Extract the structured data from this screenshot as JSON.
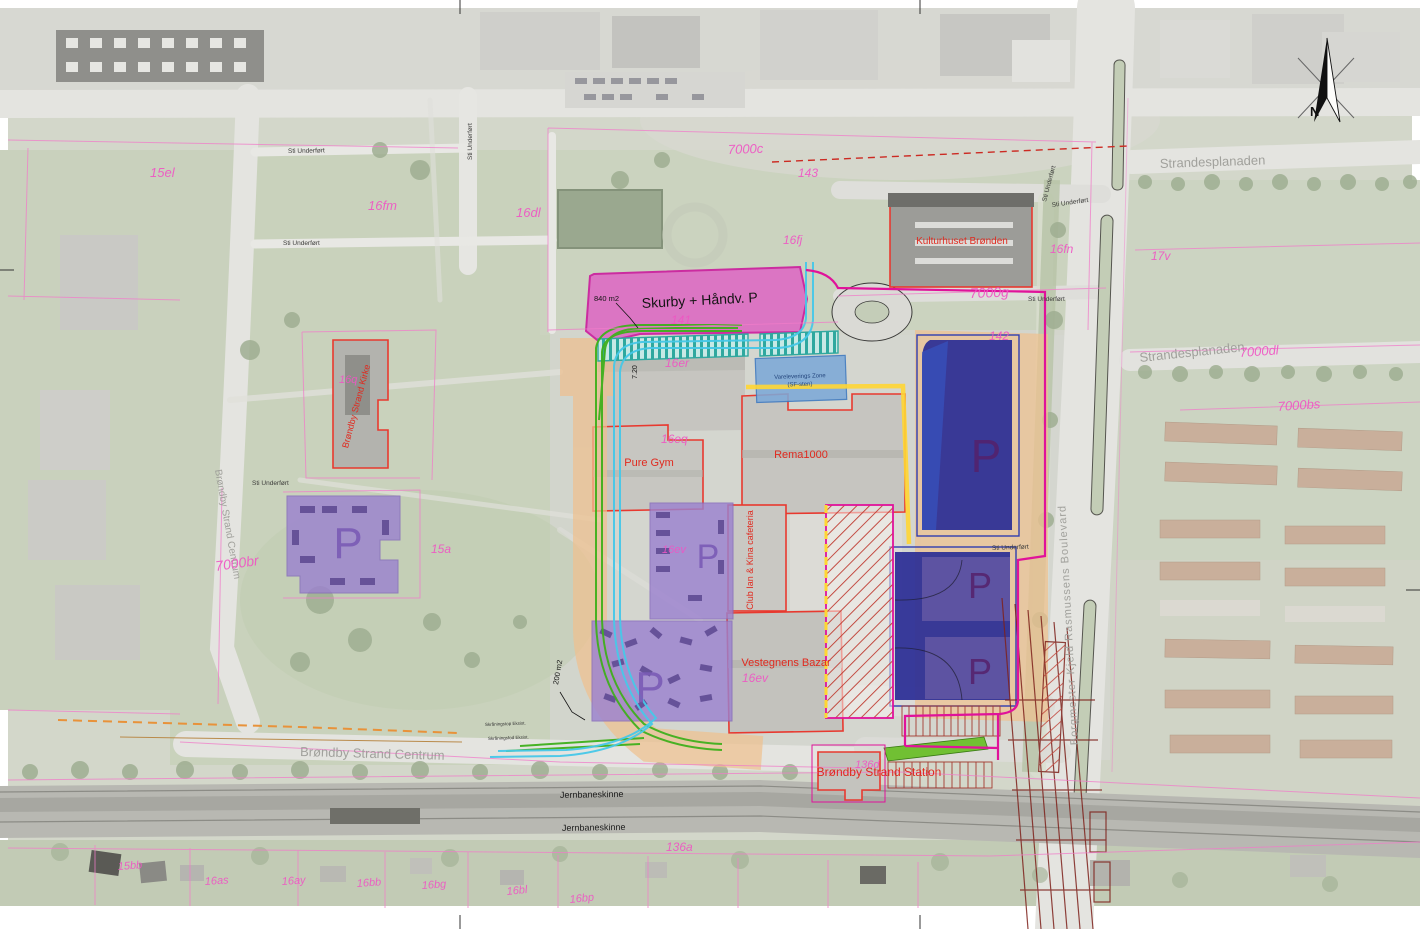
{
  "map": {
    "labels": {
      "skurby": "Skurby + Håndv. P",
      "area_840": "840 m2",
      "area_200": "200 m2",
      "depth_720": "7.20",
      "varelevering_1": "Vareleverings Zone",
      "varelevering_2": "(SF-sten)",
      "pure_gym": "Pure Gym",
      "rema": "Rema1000",
      "bazar": "Vestegnens Bazar",
      "club": "Club Ian & Kina cafeteria",
      "kulturhuset": "Kulturhuset Brønden",
      "kirke": "Brøndby Strand Kirke",
      "station": "Brøndby Strand Station",
      "p": "P",
      "north": "N",
      "skraaning_top": "Skråningstop Eksist.",
      "skraaning_fod": "Skråningsfod Eksist."
    },
    "streets": {
      "strandesplanaden": "Strandesplanaden",
      "centrum": "Brøndby Strand Centrum",
      "boulevard": "Borgmester Kjeld Rasmussens Boulevard",
      "sti": "Sti Underført",
      "jernbane": "Jernbaneskinne"
    },
    "cadastral": [
      {
        "text": "15el"
      },
      {
        "text": "16fm"
      },
      {
        "text": "16dl"
      },
      {
        "text": "17v"
      },
      {
        "text": "7000c"
      },
      {
        "text": "143"
      },
      {
        "text": "16fj"
      },
      {
        "text": "141"
      },
      {
        "text": "16er"
      },
      {
        "text": "16eq"
      },
      {
        "text": "142"
      },
      {
        "text": "7000g"
      },
      {
        "text": "16fn"
      },
      {
        "text": "7000dl"
      },
      {
        "text": "7000bs"
      },
      {
        "text": "7000br"
      },
      {
        "text": "16q"
      },
      {
        "text": "15a"
      },
      {
        "text": "16ev"
      },
      {
        "text": "16ev"
      },
      {
        "text": "136d"
      },
      {
        "text": "136a"
      },
      {
        "text": "15bb"
      },
      {
        "text": "16as"
      },
      {
        "text": "16ay"
      },
      {
        "text": "16bb"
      },
      {
        "text": "16bg"
      },
      {
        "text": "16bl"
      },
      {
        "text": "16bp"
      }
    ]
  },
  "colors": {
    "zone_pink": "#df64c4",
    "zone_pink_border": "#cc0f9a",
    "zone_purple": "#9b82cf",
    "zone_navy": "#2a2d96",
    "zone_orange": "#eec08f",
    "zone_teal": "#2fa89f",
    "zone_blue_delivery": "#7da9d8",
    "hatch_red": "#bf3b30",
    "line_green": "#3faf1c",
    "line_cyan": "#46c8e8",
    "line_yellow": "#ffd633",
    "boundary_magenta": "#e0129a",
    "cadastral_pink": "#ef56c4",
    "label_red": "#e02a1f"
  }
}
